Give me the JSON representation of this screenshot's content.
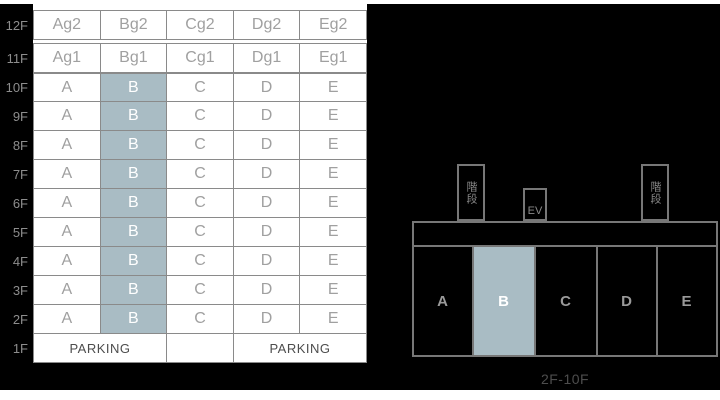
{
  "colors": {
    "panel_bg": "#000000",
    "table_cell_bg": "#ffffff",
    "table_border": "#8a8a8a",
    "plan_border": "#777777",
    "muted_text": "#a0a0a0",
    "floor_label_text": "#8d8d8d",
    "dark_text": "#4d4d4d",
    "highlight": "#a9bcc4",
    "highlight_text": "#ffffff"
  },
  "floor_table": {
    "rows": [
      {
        "floor": "12F",
        "style": "boxed",
        "cells": [
          "Ag2",
          "Bg2",
          "Cg2",
          "Dg2",
          "Eg2"
        ],
        "highlight_index": -1
      },
      {
        "floor": "11F",
        "style": "boxed",
        "cells": [
          "Ag1",
          "Bg1",
          "Cg1",
          "Dg1",
          "Eg1"
        ],
        "highlight_index": -1
      },
      {
        "floor": "10F",
        "style": "grid",
        "cells": [
          "A",
          "B",
          "C",
          "D",
          "E"
        ],
        "highlight_index": 1
      },
      {
        "floor": "9F",
        "style": "grid",
        "cells": [
          "A",
          "B",
          "C",
          "D",
          "E"
        ],
        "highlight_index": 1
      },
      {
        "floor": "8F",
        "style": "grid",
        "cells": [
          "A",
          "B",
          "C",
          "D",
          "E"
        ],
        "highlight_index": 1
      },
      {
        "floor": "7F",
        "style": "grid",
        "cells": [
          "A",
          "B",
          "C",
          "D",
          "E"
        ],
        "highlight_index": 1
      },
      {
        "floor": "6F",
        "style": "grid",
        "cells": [
          "A",
          "B",
          "C",
          "D",
          "E"
        ],
        "highlight_index": 1
      },
      {
        "floor": "5F",
        "style": "grid",
        "cells": [
          "A",
          "B",
          "C",
          "D",
          "E"
        ],
        "highlight_index": 1
      },
      {
        "floor": "4F",
        "style": "grid",
        "cells": [
          "A",
          "B",
          "C",
          "D",
          "E"
        ],
        "highlight_index": 1
      },
      {
        "floor": "3F",
        "style": "grid",
        "cells": [
          "A",
          "B",
          "C",
          "D",
          "E"
        ],
        "highlight_index": 1
      },
      {
        "floor": "2F",
        "style": "grid",
        "cells": [
          "A",
          "B",
          "C",
          "D",
          "E"
        ],
        "highlight_index": 1
      },
      {
        "floor": "1F",
        "style": "parking",
        "parking_cells": [
          {
            "label": "PARKING",
            "span": 2
          },
          {
            "label": "",
            "span": 1
          },
          {
            "label": "PARKING",
            "span": 2
          }
        ]
      }
    ]
  },
  "floor_plan": {
    "stairs_label": "階段",
    "elevator_label": "EV",
    "units": [
      {
        "label": "A",
        "highlighted": false
      },
      {
        "label": "B",
        "highlighted": true
      },
      {
        "label": "C",
        "highlighted": false
      },
      {
        "label": "D",
        "highlighted": false
      },
      {
        "label": "E",
        "highlighted": false
      }
    ],
    "caption": "2F-10F"
  }
}
